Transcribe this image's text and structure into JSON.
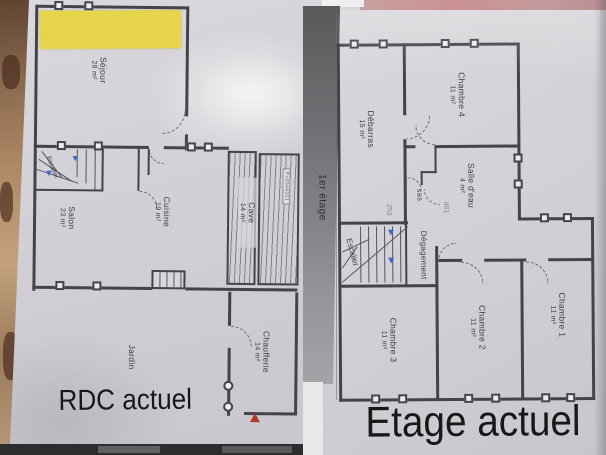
{
  "rdc": {
    "title": "RDC actuel",
    "rooms": {
      "sejour": {
        "name": "Séjour",
        "area": "28 m²"
      },
      "salon": {
        "name": "Salon",
        "area": "23 m²"
      },
      "cuisine": {
        "name": "Cuisine",
        "area": "19 m²"
      },
      "cave": {
        "name": "Cave",
        "area": "14 m²"
      },
      "chaufferie": {
        "name": "Chaufferie",
        "area": "14 m²"
      },
      "jardin": {
        "name": "Jardin"
      },
      "escalier": {
        "name": "Escalier"
      }
    },
    "stamp": "P=0546001"
  },
  "etage": {
    "title": "Etage actuel",
    "edge_label": "1er étage",
    "rooms": {
      "chambre4": {
        "name": "Chambre 4",
        "area": "11 m²"
      },
      "debarras": {
        "name": "Débarras",
        "area": "15 m²"
      },
      "salle_eau": {
        "name": "Salle d'eau",
        "area": "4 m²"
      },
      "sas": {
        "name": "sas"
      },
      "degagement": {
        "name": "Dégagement"
      },
      "escalier": {
        "name": "Escalier"
      },
      "chambre3": {
        "name": "Chambre 3",
        "area": "11 m²"
      },
      "chambre2": {
        "name": "Chambre 2",
        "area": "11 m²"
      },
      "chambre1": {
        "name": "Chambre 1",
        "area": "11 m²"
      }
    },
    "annotations": {
      "dim1": "253",
      "dim2": "461"
    }
  },
  "colors": {
    "highlight_yellow": "#e6d44b",
    "wall": "#43434a",
    "stair_arrow_blue": "#3a66c5",
    "marker_red": "#b0392c",
    "paper": "#d3d1d5"
  }
}
